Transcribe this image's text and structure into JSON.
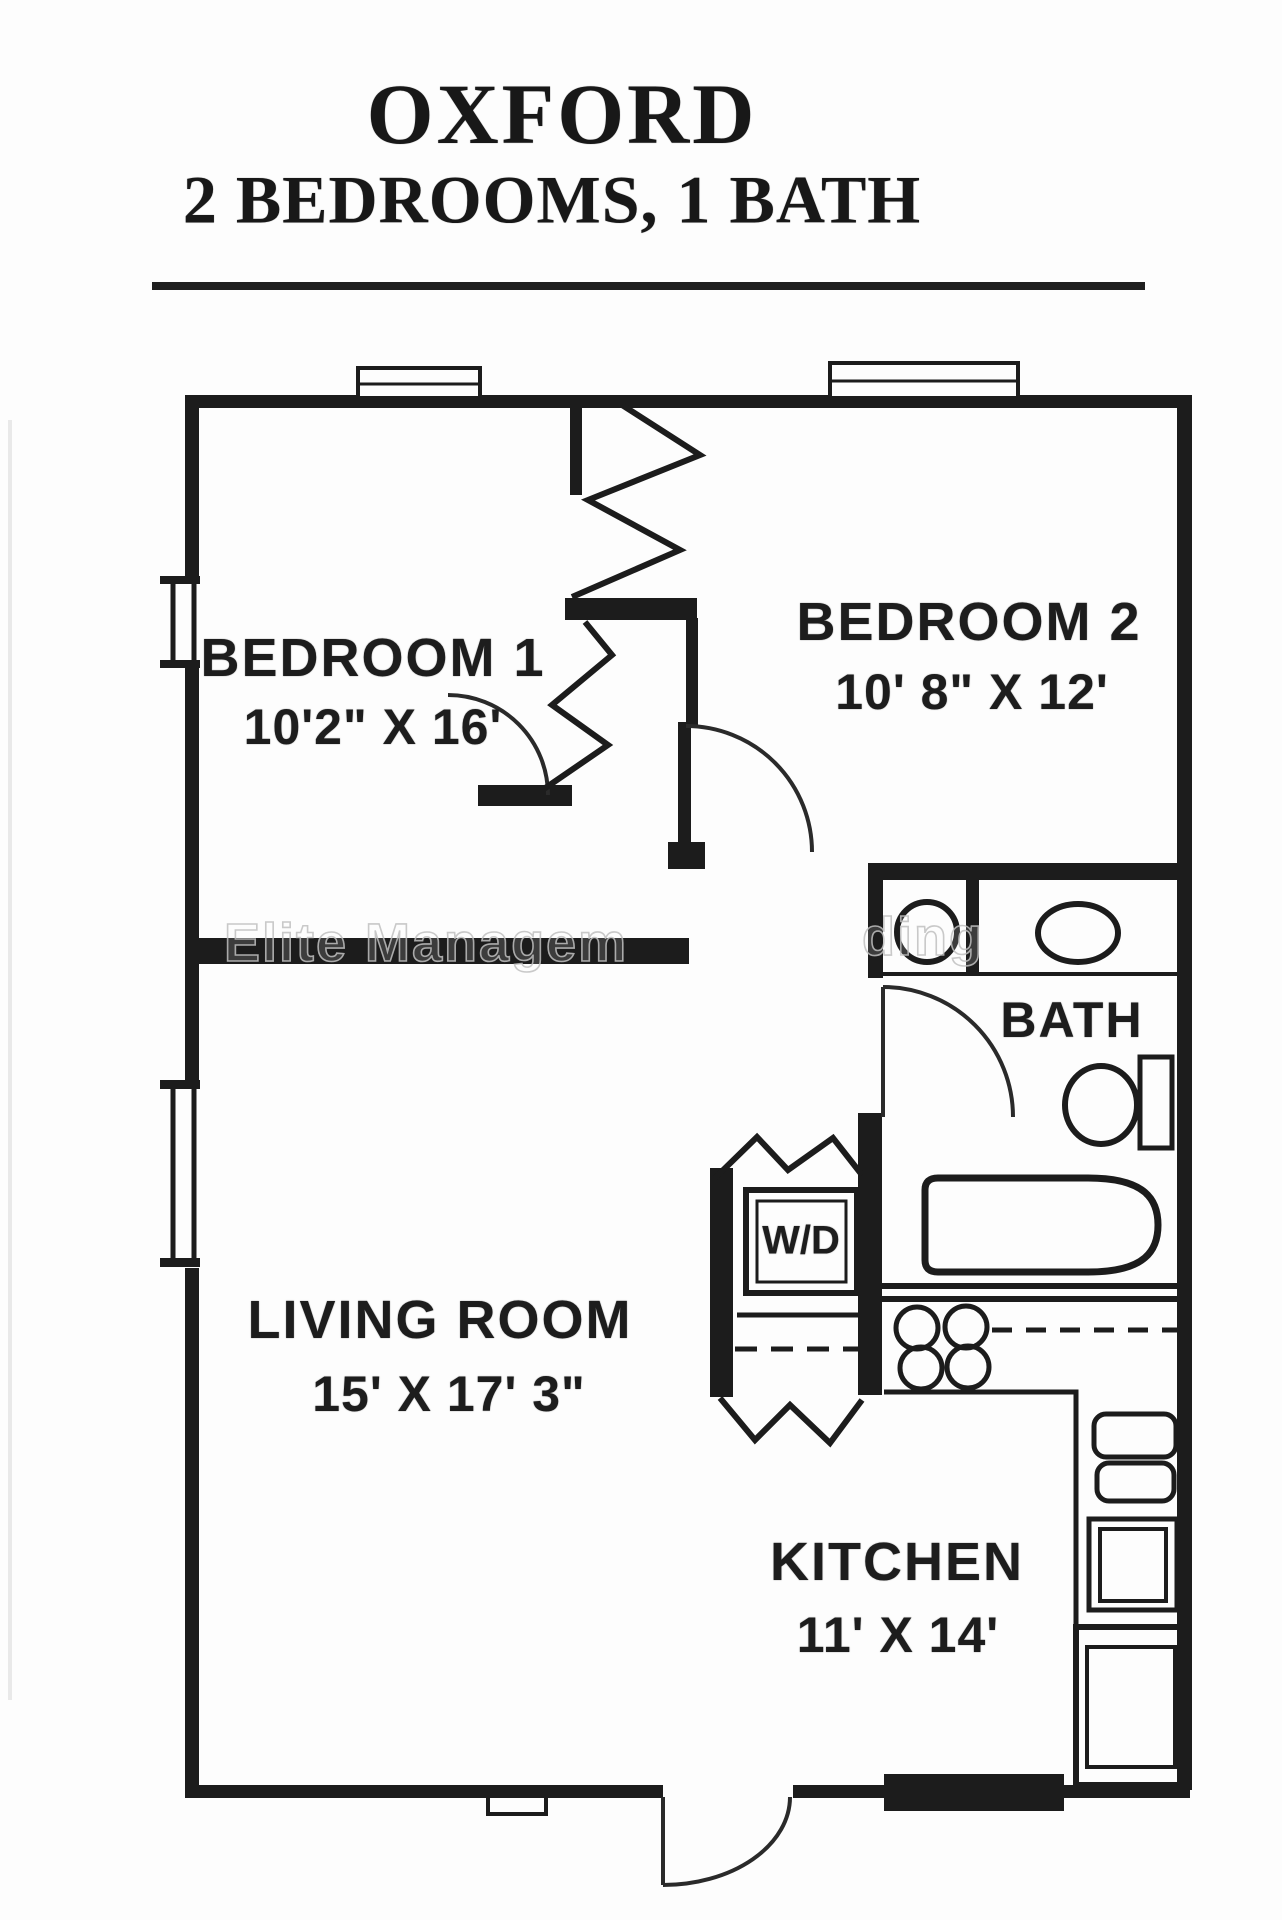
{
  "title": {
    "name": "OXFORD",
    "subtitle": "2 BEDROOMS, 1 BATH"
  },
  "rooms": {
    "bedroom1": {
      "name": "BEDROOM 1",
      "dims": "10'2\" X 16'"
    },
    "bedroom2": {
      "name": "BEDROOM 2",
      "dims": "10' 8\" X 12'"
    },
    "living_room": {
      "name": "LIVING ROOM",
      "dims": "15' X 17' 3\""
    },
    "kitchen": {
      "name": "KITCHEN",
      "dims": "11' X 14'"
    },
    "bath": {
      "name": "BATH"
    },
    "laundry": {
      "name": "W/D"
    }
  },
  "watermark": {
    "fragment_left": "Elite Managem",
    "fragment_right": "ding"
  },
  "colors": {
    "line": "#1c1c1c",
    "background": "#fdfdfd",
    "watermark_stroke": "#bebebe"
  }
}
